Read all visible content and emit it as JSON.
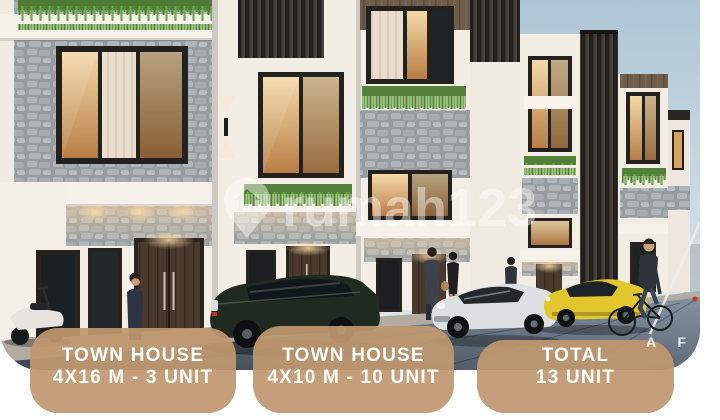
{
  "badges": [
    {
      "line1": "TOWN HOUSE",
      "line2": "4X16 M - 3 UNIT"
    },
    {
      "line1": "TOWN HOUSE",
      "line2": "4X10 M - 10 UNIT"
    },
    {
      "line1": "TOTAL",
      "line2": "13 UNIT"
    }
  ],
  "watermark": {
    "text": "rumah123",
    "icon": "map-pin-house-icon"
  },
  "corner_watermark": {
    "text": "A F A"
  },
  "colors": {
    "badge_bg": "#C0986F",
    "badge_text": "#FFFFFF",
    "watermark_white": "#FFFFFF",
    "sky": "#B9CEDC",
    "wall_white": "#F3EEE7",
    "stone_grey": "#A9AFB2",
    "wood_brown": "#6E5B49",
    "window_frame": "#23211E",
    "warm_light": "#E3A963",
    "plant_green": "#5F9640",
    "road": "#4A5664",
    "car_dark": "#202A20",
    "car_white": "#DCE0E3",
    "car_yellow": "#E2C62E"
  }
}
